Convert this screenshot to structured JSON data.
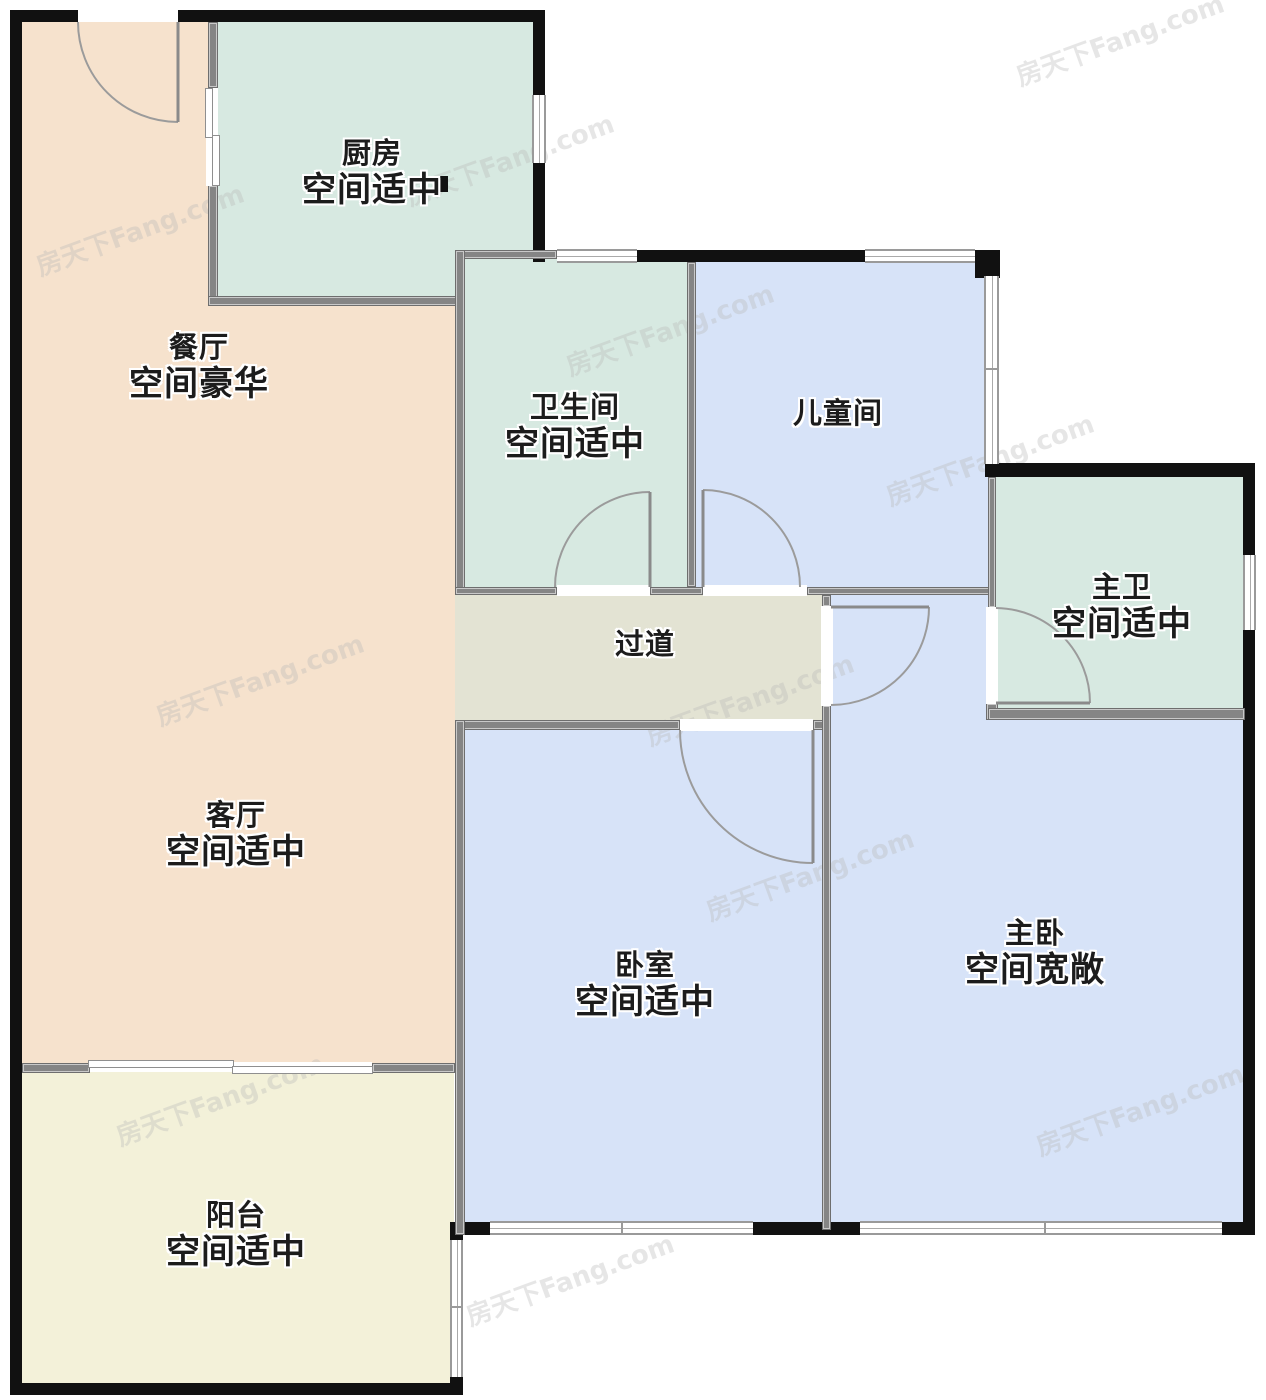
{
  "plan": {
    "type": "floor-plan",
    "watermark_text": "房天下Fang.com",
    "colors": {
      "dining_living": "#f6e2cd",
      "kitchen_bath": "#d7e9e1",
      "bedrooms": "#d7e3f8",
      "hallway": "#e3e3d3",
      "balcony": "#f3f1d9",
      "exterior_wall": "#111111",
      "interior_wall": "#858585"
    },
    "rooms": {
      "kitchen": {
        "name": "厨房",
        "status": "空间适中"
      },
      "dining": {
        "name": "餐厅",
        "status": "空间豪华"
      },
      "bathroom": {
        "name": "卫生间",
        "status": "空间适中"
      },
      "kids_room": {
        "name": "儿童间",
        "status": ""
      },
      "master_bath": {
        "name": "主卫",
        "status": "空间适中"
      },
      "hallway": {
        "name": "过道",
        "status": ""
      },
      "living": {
        "name": "客厅",
        "status": "空间适中"
      },
      "bedroom": {
        "name": "卧室",
        "status": "空间适中"
      },
      "master_bedroom": {
        "name": "主卧",
        "status": "空间宽敞"
      },
      "balcony": {
        "name": "阳台",
        "status": "空间适中"
      }
    }
  }
}
